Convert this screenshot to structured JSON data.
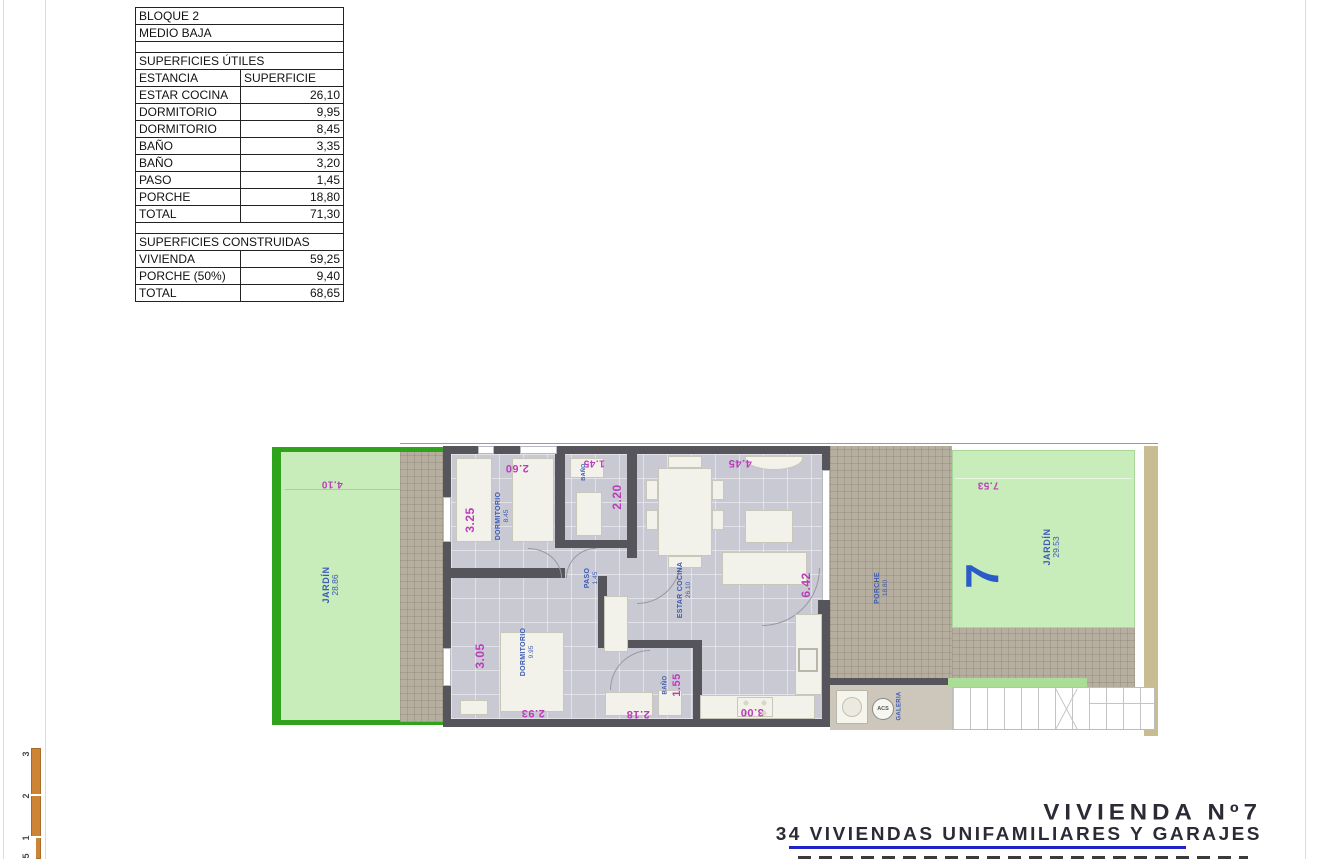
{
  "surface_table": {
    "rows": [
      {
        "label": "BLOQUE 2",
        "span": true
      },
      {
        "label": "MEDIO BAJA",
        "span": true
      },
      {
        "label": "",
        "span": true,
        "empty": true
      },
      {
        "label": "SUPERFICIES ÚTILES",
        "span": true
      },
      {
        "label": "ESTANCIA",
        "value": "SUPERFICIE",
        "header": true
      },
      {
        "label": "ESTAR COCINA",
        "value": "26,10"
      },
      {
        "label": "DORMITORIO",
        "value": "9,95"
      },
      {
        "label": "DORMITORIO",
        "value": "8,45"
      },
      {
        "label": "BAÑO",
        "value": "3,35"
      },
      {
        "label": "BAÑO",
        "value": "3,20"
      },
      {
        "label": "PASO",
        "value": "1,45"
      },
      {
        "label": "PORCHE",
        "value": "18,80"
      },
      {
        "label": "TOTAL",
        "value": "71,30"
      },
      {
        "label": "",
        "span": true,
        "empty": true
      },
      {
        "label": "SUPERFICIES CONSTRUIDAS",
        "span": true
      },
      {
        "label": "VIVIENDA",
        "value": "59,25"
      },
      {
        "label": "PORCHE (50%)",
        "value": "9,40"
      },
      {
        "label": "TOTAL",
        "value": "68,65"
      }
    ]
  },
  "plan": {
    "watermark_line1": "PROPERTIES",
    "watermark_line2": "REAL ESTATE",
    "left_garden": {
      "label": "JARDÍN",
      "area": "28.86",
      "dim_top": "4.10"
    },
    "right_garden": {
      "label": "JARDÍN",
      "area": "29.53",
      "dim_top": "7.53"
    },
    "unit_number": "7",
    "dorm_top": {
      "label": "DORMITORIO",
      "area": "8.45",
      "dim_top": "2.60",
      "dim_left": "3.25"
    },
    "dorm_bottom": {
      "label": "DORMITORIO",
      "area": "9.95",
      "dim_left": "3.05",
      "dim_bottom": "2.93"
    },
    "bath_top": {
      "label": "BAÑO",
      "dim_top": "1.45",
      "dim_right": "2.20"
    },
    "bath_bottom": {
      "label": "BAÑO",
      "dim": "1.55",
      "dim_bottom": "2.18"
    },
    "paso": {
      "label": "PASO",
      "area": "1.45"
    },
    "estar": {
      "label": "ESTAR COCINA",
      "area": "26.10",
      "dim_top": "4.45",
      "dim_right": "6.42",
      "dim_bottom": "3.00"
    },
    "porche": {
      "label": "PORCHE",
      "area": "18.80"
    },
    "galeria": {
      "label": "GALERIA",
      "acs": "ACS"
    },
    "colors": {
      "garden": "#c8ecba",
      "garden_border": "#2fa31c",
      "wall": "#56555c",
      "floor": "#c9c9d3",
      "hatch": "#b6ae9f",
      "dimension": "#bb3cbb",
      "room_label": "#3c5bb4",
      "unit_number": "#2b5bc7",
      "side_strip": "#c8bc92"
    }
  },
  "titleblock": {
    "line1": "VIVIENDA Nº7",
    "line2": "34 VIVIENDAS UNIFAMILIARES Y GARAJES",
    "rule_color": "#2121c4"
  },
  "scalebar": {
    "ticks": [
      "3",
      "2",
      "1",
      "5"
    ],
    "color": "#cd8434"
  }
}
